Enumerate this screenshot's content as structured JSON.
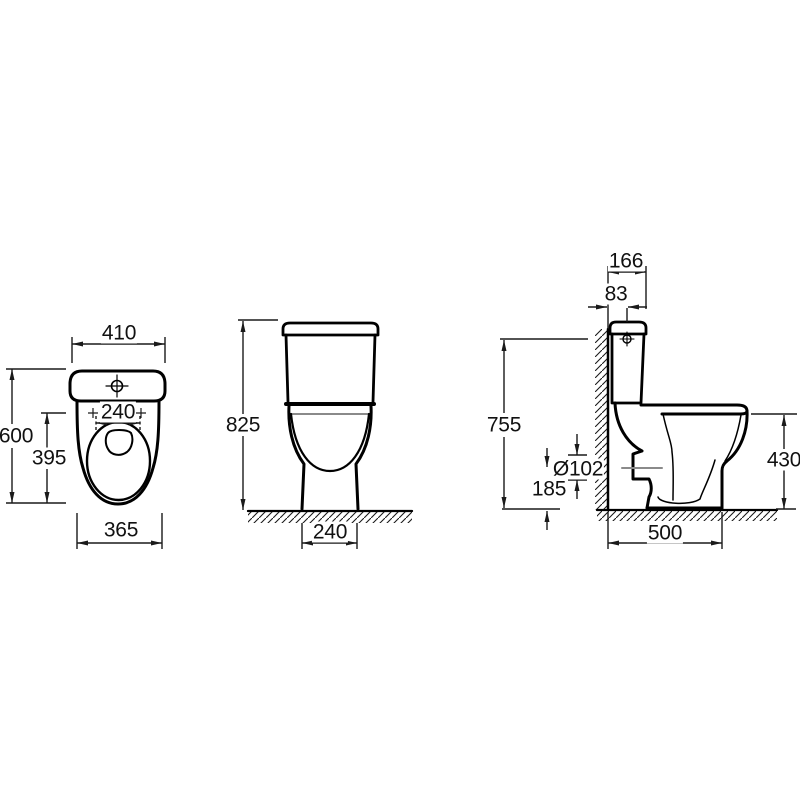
{
  "drawing": {
    "type": "sanitary-ware technical dimension drawing, three orthographic views of a close-coupled toilet",
    "units_implied": "mm",
    "colors": {
      "outline": "#000000",
      "dimension_lines": "#1a1a1a",
      "centerline_gray": "#8a8a8a",
      "background": "#ffffff"
    },
    "top_view": {
      "dims": {
        "overall_width": "410",
        "seat_hinge_width": "240",
        "overall_depth": "600",
        "seat_depth": "395",
        "footprint_width": "365"
      }
    },
    "front_view": {
      "dims": {
        "overall_height": "825",
        "pedestal_width": "240"
      }
    },
    "side_view": {
      "dims": {
        "cistern_lid_depth": "166",
        "inlet_offset_from_wall": "83",
        "inlet_height": "755",
        "outlet_diameter": "Ø102",
        "outlet_centre_height": "185",
        "rim_height": "430",
        "footprint_depth": "500"
      }
    }
  }
}
